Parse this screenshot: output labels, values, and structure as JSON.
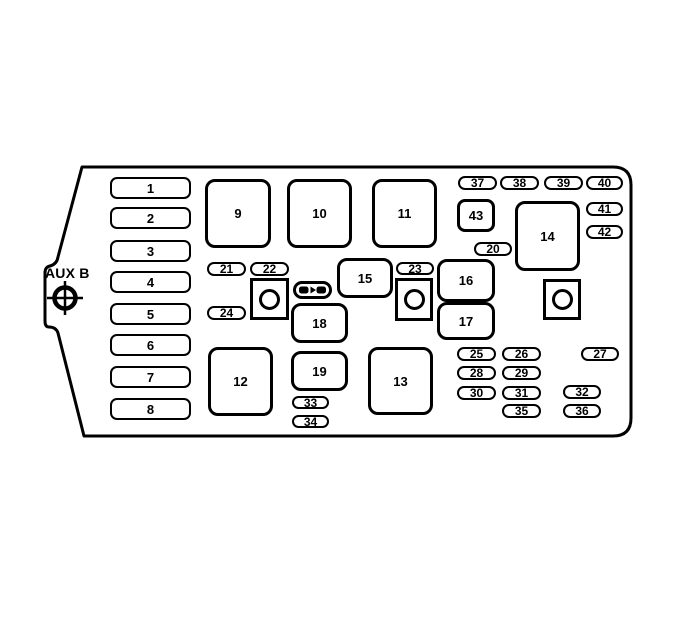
{
  "diagram": {
    "description": "Fuse block diagram with numbered fuse and relay slots",
    "aux_label": "AUX B",
    "colors": {
      "line": "#000000",
      "background": "#ffffff"
    },
    "slots": [
      {
        "label": "1",
        "kind": "fuse",
        "x": 110,
        "y": 177,
        "w": 81,
        "h": 22
      },
      {
        "label": "2",
        "kind": "fuse",
        "x": 110,
        "y": 207,
        "w": 81,
        "h": 22
      },
      {
        "label": "3",
        "kind": "fuse",
        "x": 110,
        "y": 240,
        "w": 81,
        "h": 22
      },
      {
        "label": "4",
        "kind": "fuse",
        "x": 110,
        "y": 271,
        "w": 81,
        "h": 22
      },
      {
        "label": "5",
        "kind": "fuse",
        "x": 110,
        "y": 303,
        "w": 81,
        "h": 22
      },
      {
        "label": "6",
        "kind": "fuse",
        "x": 110,
        "y": 334,
        "w": 81,
        "h": 22
      },
      {
        "label": "7",
        "kind": "fuse",
        "x": 110,
        "y": 366,
        "w": 81,
        "h": 22
      },
      {
        "label": "8",
        "kind": "fuse",
        "x": 110,
        "y": 398,
        "w": 81,
        "h": 22
      },
      {
        "label": "9",
        "kind": "box",
        "x": 205,
        "y": 179,
        "w": 66,
        "h": 69
      },
      {
        "label": "10",
        "kind": "box",
        "x": 287,
        "y": 179,
        "w": 65,
        "h": 69
      },
      {
        "label": "11",
        "kind": "box",
        "x": 372,
        "y": 179,
        "w": 65,
        "h": 69
      },
      {
        "label": "12",
        "kind": "box",
        "x": 208,
        "y": 347,
        "w": 65,
        "h": 69
      },
      {
        "label": "13",
        "kind": "box",
        "x": 368,
        "y": 347,
        "w": 65,
        "h": 68
      },
      {
        "label": "14",
        "kind": "box",
        "x": 515,
        "y": 201,
        "w": 65,
        "h": 70
      },
      {
        "label": "15",
        "kind": "box",
        "x": 337,
        "y": 258,
        "w": 56,
        "h": 40
      },
      {
        "label": "16",
        "kind": "box",
        "x": 437,
        "y": 259,
        "w": 58,
        "h": 43
      },
      {
        "label": "17",
        "kind": "box",
        "x": 437,
        "y": 302,
        "w": 58,
        "h": 38
      },
      {
        "label": "18",
        "kind": "box",
        "x": 291,
        "y": 303,
        "w": 57,
        "h": 40
      },
      {
        "label": "19",
        "kind": "box",
        "x": 291,
        "y": 351,
        "w": 57,
        "h": 40
      },
      {
        "label": "20",
        "kind": "pill",
        "x": 474,
        "y": 242,
        "w": 38,
        "h": 14
      },
      {
        "label": "21",
        "kind": "pill",
        "x": 207,
        "y": 262,
        "w": 39,
        "h": 14
      },
      {
        "label": "22",
        "kind": "pill",
        "x": 250,
        "y": 262,
        "w": 39,
        "h": 14
      },
      {
        "label": "23",
        "kind": "pill",
        "x": 396,
        "y": 262,
        "w": 38,
        "h": 13
      },
      {
        "label": "24",
        "kind": "pill",
        "x": 207,
        "y": 306,
        "w": 39,
        "h": 14
      },
      {
        "label": "25",
        "kind": "pill",
        "x": 457,
        "y": 347,
        "w": 39,
        "h": 14
      },
      {
        "label": "26",
        "kind": "pill",
        "x": 502,
        "y": 347,
        "w": 39,
        "h": 14
      },
      {
        "label": "27",
        "kind": "pill",
        "x": 581,
        "y": 347,
        "w": 38,
        "h": 14
      },
      {
        "label": "28",
        "kind": "pill",
        "x": 457,
        "y": 366,
        "w": 39,
        "h": 14
      },
      {
        "label": "29",
        "kind": "pill",
        "x": 502,
        "y": 366,
        "w": 39,
        "h": 14
      },
      {
        "label": "30",
        "kind": "pill",
        "x": 457,
        "y": 386,
        "w": 39,
        "h": 14
      },
      {
        "label": "31",
        "kind": "pill",
        "x": 502,
        "y": 386,
        "w": 39,
        "h": 14
      },
      {
        "label": "32",
        "kind": "pill",
        "x": 563,
        "y": 385,
        "w": 38,
        "h": 14
      },
      {
        "label": "33",
        "kind": "pill",
        "x": 292,
        "y": 396,
        "w": 37,
        "h": 13
      },
      {
        "label": "34",
        "kind": "pill",
        "x": 292,
        "y": 415,
        "w": 37,
        "h": 13
      },
      {
        "label": "35",
        "kind": "pill",
        "x": 502,
        "y": 404,
        "w": 39,
        "h": 14
      },
      {
        "label": "36",
        "kind": "pill",
        "x": 563,
        "y": 404,
        "w": 38,
        "h": 14
      },
      {
        "label": "37",
        "kind": "pill",
        "x": 458,
        "y": 176,
        "w": 39,
        "h": 14
      },
      {
        "label": "38",
        "kind": "pill",
        "x": 500,
        "y": 176,
        "w": 39,
        "h": 14
      },
      {
        "label": "39",
        "kind": "pill",
        "x": 544,
        "y": 176,
        "w": 39,
        "h": 14
      },
      {
        "label": "40",
        "kind": "pill",
        "x": 586,
        "y": 176,
        "w": 37,
        "h": 14
      },
      {
        "label": "41",
        "kind": "pill",
        "x": 586,
        "y": 202,
        "w": 37,
        "h": 14
      },
      {
        "label": "42",
        "kind": "pill",
        "x": 586,
        "y": 225,
        "w": 37,
        "h": 14
      },
      {
        "label": "43",
        "kind": "smallbox",
        "x": 457,
        "y": 199,
        "w": 38,
        "h": 33
      },
      {
        "label": "",
        "kind": "relay",
        "x": 250,
        "y": 278,
        "w": 39,
        "h": 42
      },
      {
        "label": "",
        "kind": "relay",
        "x": 395,
        "y": 278,
        "w": 38,
        "h": 43
      },
      {
        "label": "",
        "kind": "relay",
        "x": 543,
        "y": 279,
        "w": 38,
        "h": 41
      }
    ],
    "icons": [
      {
        "name": "fuse-puller-icon",
        "x": 293,
        "y": 281,
        "w": 39,
        "h": 18
      },
      {
        "name": "aux-b-target-icon",
        "cx": 65,
        "cy": 298
      }
    ]
  }
}
